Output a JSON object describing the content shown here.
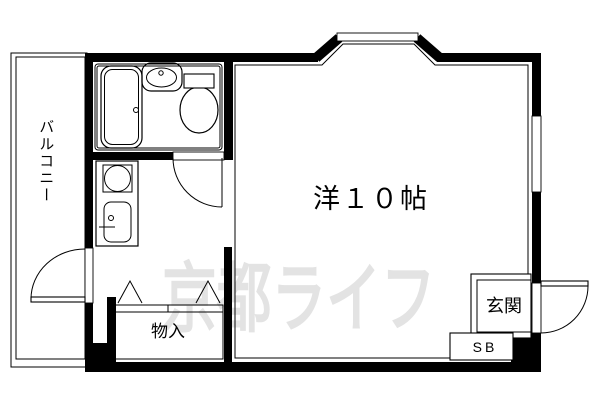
{
  "labels": {
    "balcony": "バルコニー",
    "main_room": "洋１０帖",
    "closet": "物入",
    "entrance": "玄関",
    "shoe_box": "SB"
  },
  "watermark": {
    "text": "京都ライフ"
  },
  "colors": {
    "line": "#000000",
    "background": "#ffffff",
    "watermark": "#e3e3e3"
  },
  "fixtures": [
    "bathtub",
    "washbasin",
    "toilet",
    "kitchen-unit",
    "stove-burner",
    "kitchen-sink",
    "bay-window",
    "right-window",
    "balcony-door",
    "bathroom-door",
    "entrance-door",
    "storage-closet",
    "entrance-step",
    "shoe-box"
  ]
}
